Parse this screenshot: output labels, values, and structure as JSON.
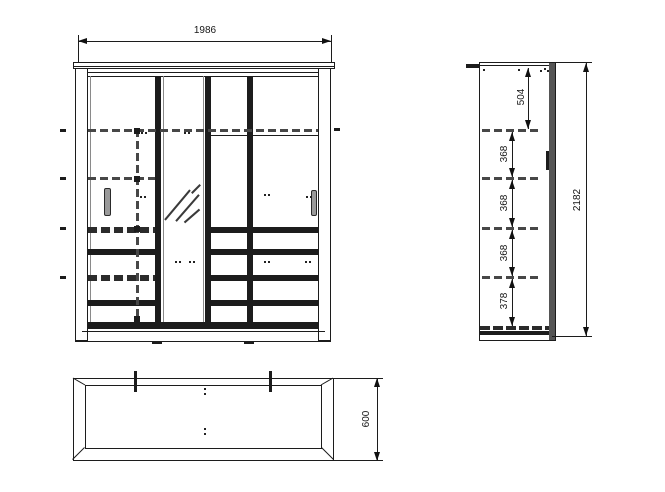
{
  "dimensions": {
    "front_width": "1986",
    "side_top_offset": "504",
    "side_shelf_gaps": [
      "368",
      "368",
      "368"
    ],
    "side_bottom_gap": "378",
    "side_total_height": "2182",
    "plan_depth": "600"
  }
}
